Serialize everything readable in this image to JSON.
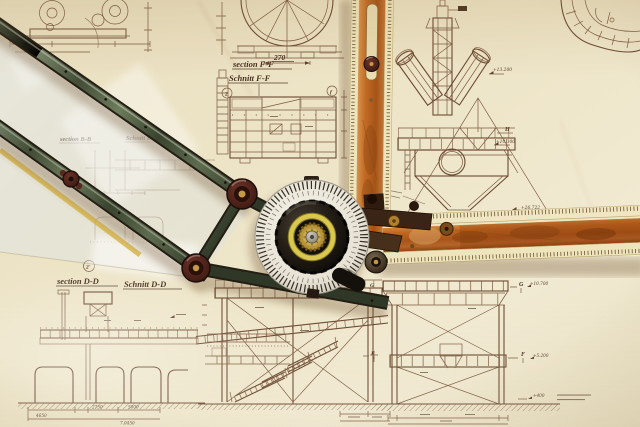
{
  "scene": {
    "type": "photograph",
    "subject": "Drafting machine with protractor head and wooden scale rulers lying on sepia engineering blueprints",
    "paper_color": "#ece3c6",
    "line_color": "#7b5a40",
    "arm_color": "#5c6a4e",
    "pivot_color": "#552822",
    "ruler_wood_color": "#c06a24",
    "ruler_edge_color": "#efe5bd",
    "dial_color": "#eceade",
    "knob_color": "#16110c",
    "accent_yellow": "#d9c84e"
  },
  "drawings": {
    "tank_plan": {
      "dim": "270"
    },
    "section_ff": {
      "label_en": "section F-F",
      "label_de": "Schnitt F-F",
      "marker_left": "2",
      "marker_right": "f"
    },
    "section_bb": {
      "label_en": "section B-B",
      "label_de": "Schnitt B-B"
    },
    "section_dd": {
      "label_en": "section D-D",
      "label_de": "Schnitt D-D",
      "marker": "2'",
      "dims": [
        "2750",
        "5000",
        "4650",
        "7.0450"
      ]
    },
    "ypipe": {
      "elev_top": "+13.200",
      "level": "H",
      "elev_mid": "+10.300"
    },
    "aframe": {
      "elev": "+26.722"
    },
    "trestle_right": {
      "level_top": "G",
      "elev_top": "+10.700",
      "level_mid": "F",
      "elev_mid": "+5.200",
      "elev_base": "+400"
    },
    "trestle_center": {
      "level_top": "G",
      "level_mid": "F"
    }
  }
}
